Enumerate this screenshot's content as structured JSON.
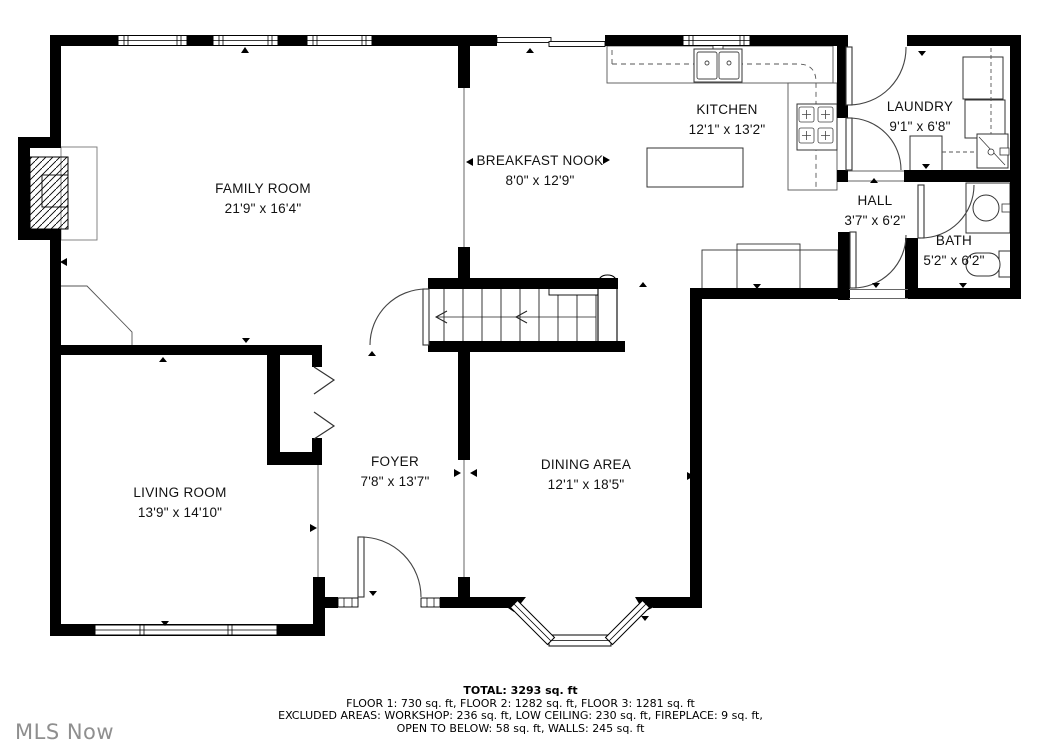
{
  "watermark": "MLS Now",
  "rooms": {
    "family_room": {
      "name": "FAMILY ROOM",
      "dims": "21'9\" x 16'4\""
    },
    "breakfast_nook": {
      "name": "BREAKFAST NOOK",
      "dims": "8'0\" x 12'9\""
    },
    "kitchen": {
      "name": "KITCHEN",
      "dims": "12'1\" x 13'2\""
    },
    "laundry": {
      "name": "LAUNDRY",
      "dims": "9'1\" x 6'8\""
    },
    "hall": {
      "name": "HALL",
      "dims": "3'7\" x 6'2\""
    },
    "bath": {
      "name": "BATH",
      "dims": "5'2\" x 6'2\""
    },
    "living_room": {
      "name": "LIVING ROOM",
      "dims": "13'9\" x 14'10\""
    },
    "foyer": {
      "name": "FOYER",
      "dims": "7'8\" x 13'7\""
    },
    "dining_area": {
      "name": "DINING AREA",
      "dims": "12'1\" x 18'5\""
    }
  },
  "footer": {
    "total": "TOTAL: 3293 sq. ft",
    "floors": "FLOOR 1: 730 sq. ft, FLOOR 2: 1282 sq. ft, FLOOR 3: 1281 sq. ft",
    "excluded_1": "EXCLUDED AREAS: WORKSHOP: 236 sq. ft, LOW CEILING: 230 sq. ft, FIREPLACE: 9 sq. ft,",
    "excluded_2": "OPEN TO BELOW: 58 sq. ft, WALLS: 245 sq. ft"
  },
  "colors": {
    "walls": "#000000",
    "thin_lines": "#444444",
    "watermark": "#8f8f8f"
  }
}
